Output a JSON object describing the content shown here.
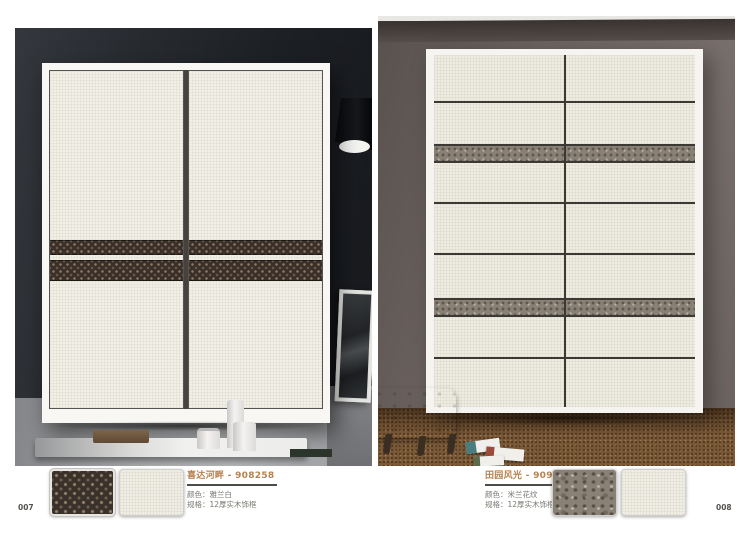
{
  "page": {
    "left_number": "007",
    "right_number": "008"
  },
  "left_product": {
    "title": "喜达河畔 - 908258",
    "color_line": "颜色：雅兰白",
    "spec_line": "规格：12厚实木饰框"
  },
  "right_product": {
    "title": "田园风光 - 909258",
    "color_line": "颜色：米兰花纹",
    "spec_line": "规格：12厚实木饰框"
  },
  "colors": {
    "title_accent": "#b5824f",
    "monogram_band": "#3a312b",
    "floral_band": "#8a8176",
    "door_cream": "#f0eee4",
    "left_wall": "#1d2025",
    "right_wall": "#6c6360",
    "carpet": "#7a5836"
  }
}
